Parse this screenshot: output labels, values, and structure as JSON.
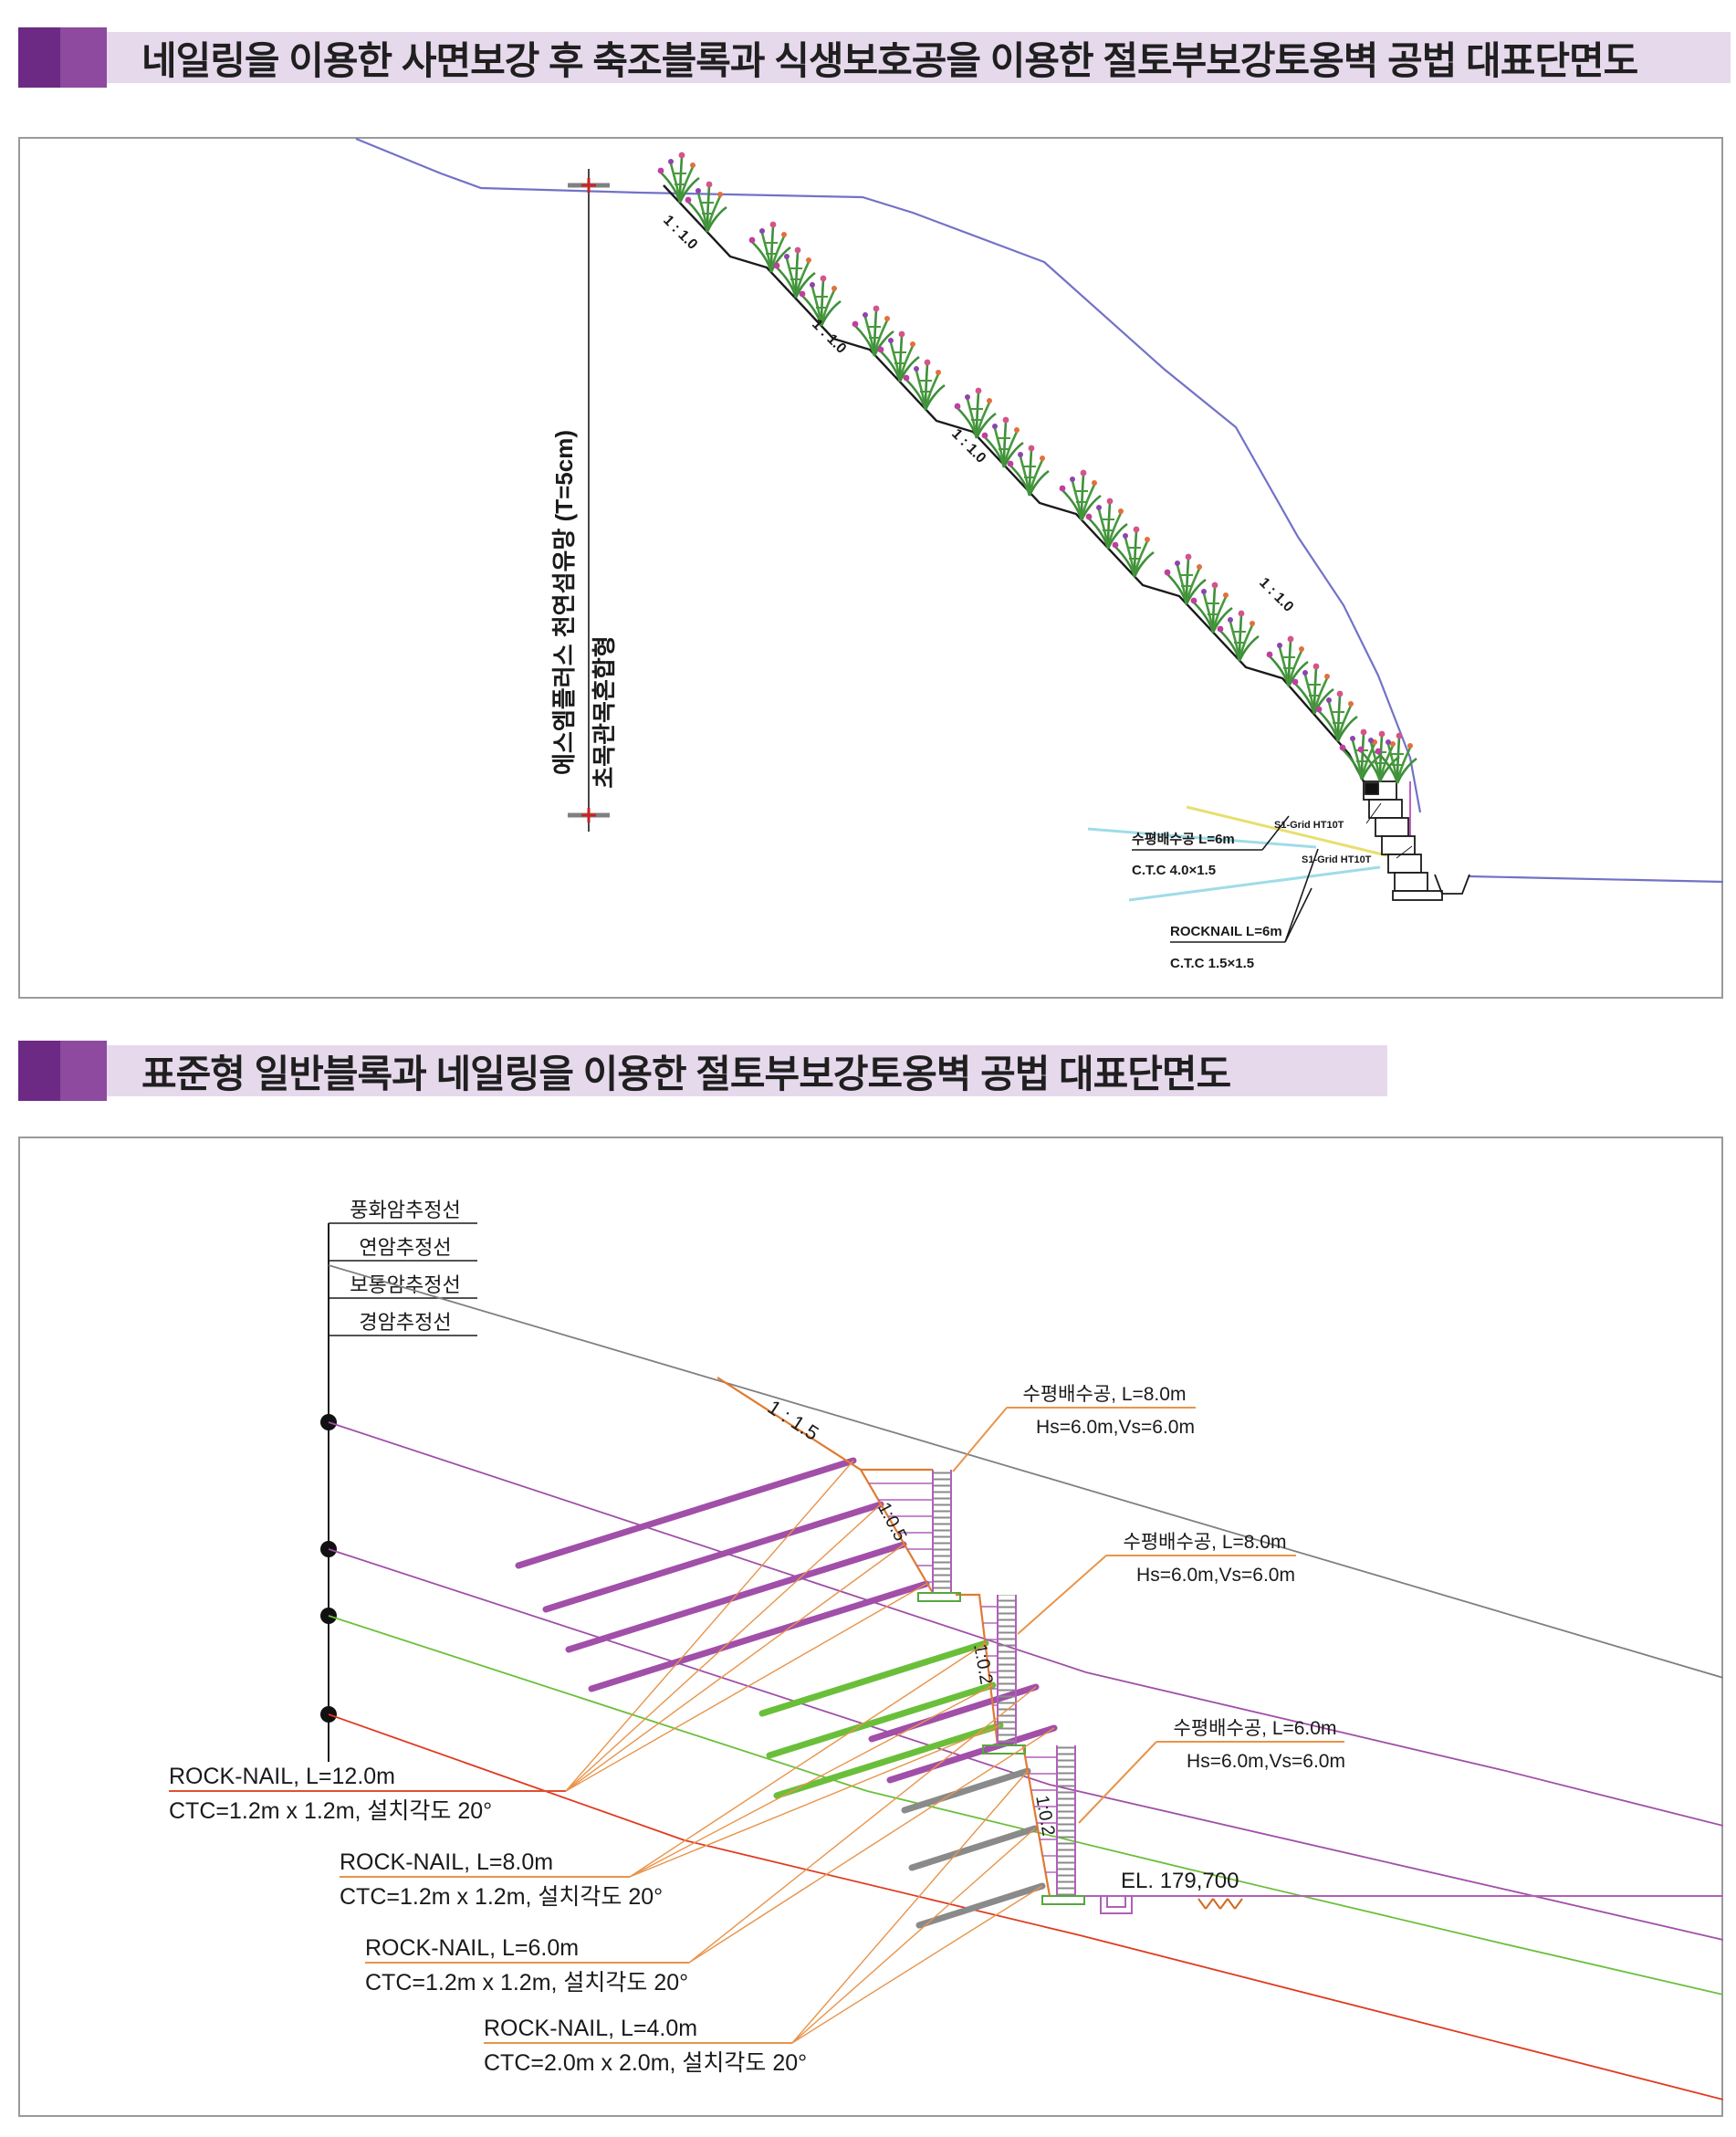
{
  "titles": {
    "section1": "네일링을 이용한 사면보강 후 축조블록과 식생보호공을 이용한 절토부보강토옹벽 공법 대표단면도",
    "section2": "표준형 일반블록과 네일링을 이용한 절토부보강토옹벽 공법 대표단면도"
  },
  "colors": {
    "accent_dark": "#6d2a85",
    "accent_mid": "#8d4a9f",
    "accent_light": "#e6d9ec",
    "ground_blue": "#7272c8",
    "drain_yellow": "#e8df6e",
    "nail_cyan": "#9fdce8",
    "nail_purple": "#a14fa8",
    "nail_green": "#6abf3a",
    "nail_gray": "#8a8a8a",
    "cut_orange": "#e07a30",
    "layer_red": "#e03a20"
  },
  "panel1": {
    "net_label": "에스엠플러스 천연섬유망 (T=5cm)",
    "veg_label": "초목관목혼합형",
    "slope_ratio": "1 : 1.0",
    "grid_label_1": "S1-Grid HT10T",
    "grid_label_2": "S1-Grid HT10T",
    "drain": {
      "line1": "수평배수공 L=6m",
      "line2": "C.T.C 4.0×1.5"
    },
    "rocknail": {
      "line1": "ROCKNAIL L=6m",
      "line2": "C.T.C 1.5×1.5"
    }
  },
  "panel2": {
    "strata": [
      "풍화암추정선",
      "연암추정선",
      "보통암추정선",
      "경암추정선"
    ],
    "slope_main": "1 : 1.5",
    "slope_wall1": "1:0.5",
    "slope_wall2": "1:0.2",
    "slope_wall3": "1:0.2",
    "drains": [
      {
        "line1": "수평배수공, L=8.0m",
        "line2": "Hs=6.0m,Vs=6.0m"
      },
      {
        "line1": "수평배수공, L=8.0m",
        "line2": "Hs=6.0m,Vs=6.0m"
      },
      {
        "line1": "수평배수공, L=6.0m",
        "line2": "Hs=6.0m,Vs=6.0m"
      }
    ],
    "nails": [
      {
        "line1": "ROCK-NAIL, L=12.0m",
        "line2": "CTC=1.2m x 1.2m, 설치각도 20°"
      },
      {
        "line1": "ROCK-NAIL, L=8.0m",
        "line2": "CTC=1.2m x 1.2m, 설치각도 20°"
      },
      {
        "line1": "ROCK-NAIL, L=6.0m",
        "line2": "CTC=1.2m x 1.2m, 설치각도 20°"
      },
      {
        "line1": "ROCK-NAIL, L=4.0m",
        "line2": "CTC=2.0m x 2.0m, 설치각도 20°"
      }
    ],
    "elevation": "EL. 179,700"
  }
}
